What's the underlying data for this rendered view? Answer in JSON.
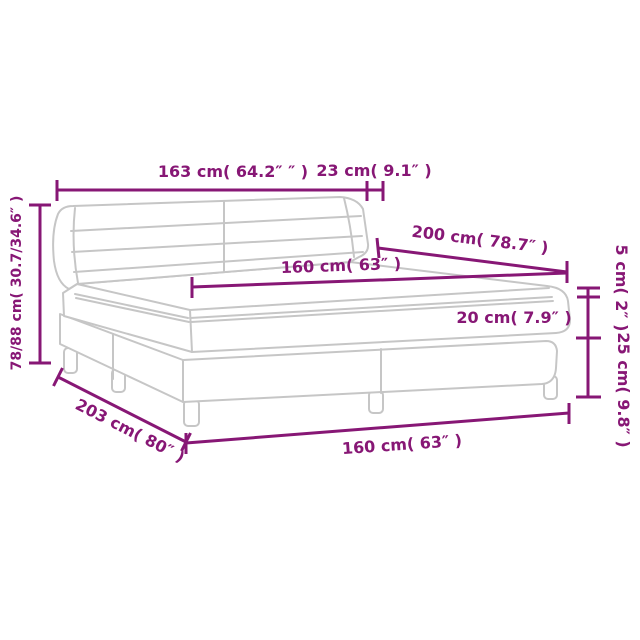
{
  "diagram": {
    "kind": "product-dimension-line-drawing",
    "subject": "box-spring-bed-with-headboard-mattress-and-topper",
    "colors": {
      "annotation": "#871775",
      "artwork_line": "#c6c6c6",
      "background": "#ffffff"
    },
    "labels": {
      "headboard_width": "163 cm( 64.2″ ″ )",
      "headboard_depth": "23 cm( 9.1″ )",
      "headboard_height": "78/88 cm( 30.7/34.6″ )",
      "bed_length": "200 cm( 78.7″ )",
      "mattress_width": "160 cm( 63″ )",
      "topper_height": "5 cm( 2″ )",
      "mattress_height": "20 cm( 7.9″ )",
      "base_height": "25 cm( 9.8″ )",
      "total_length": "203 cm( 80″ )",
      "base_width": "160 cm( 63″ )"
    }
  }
}
